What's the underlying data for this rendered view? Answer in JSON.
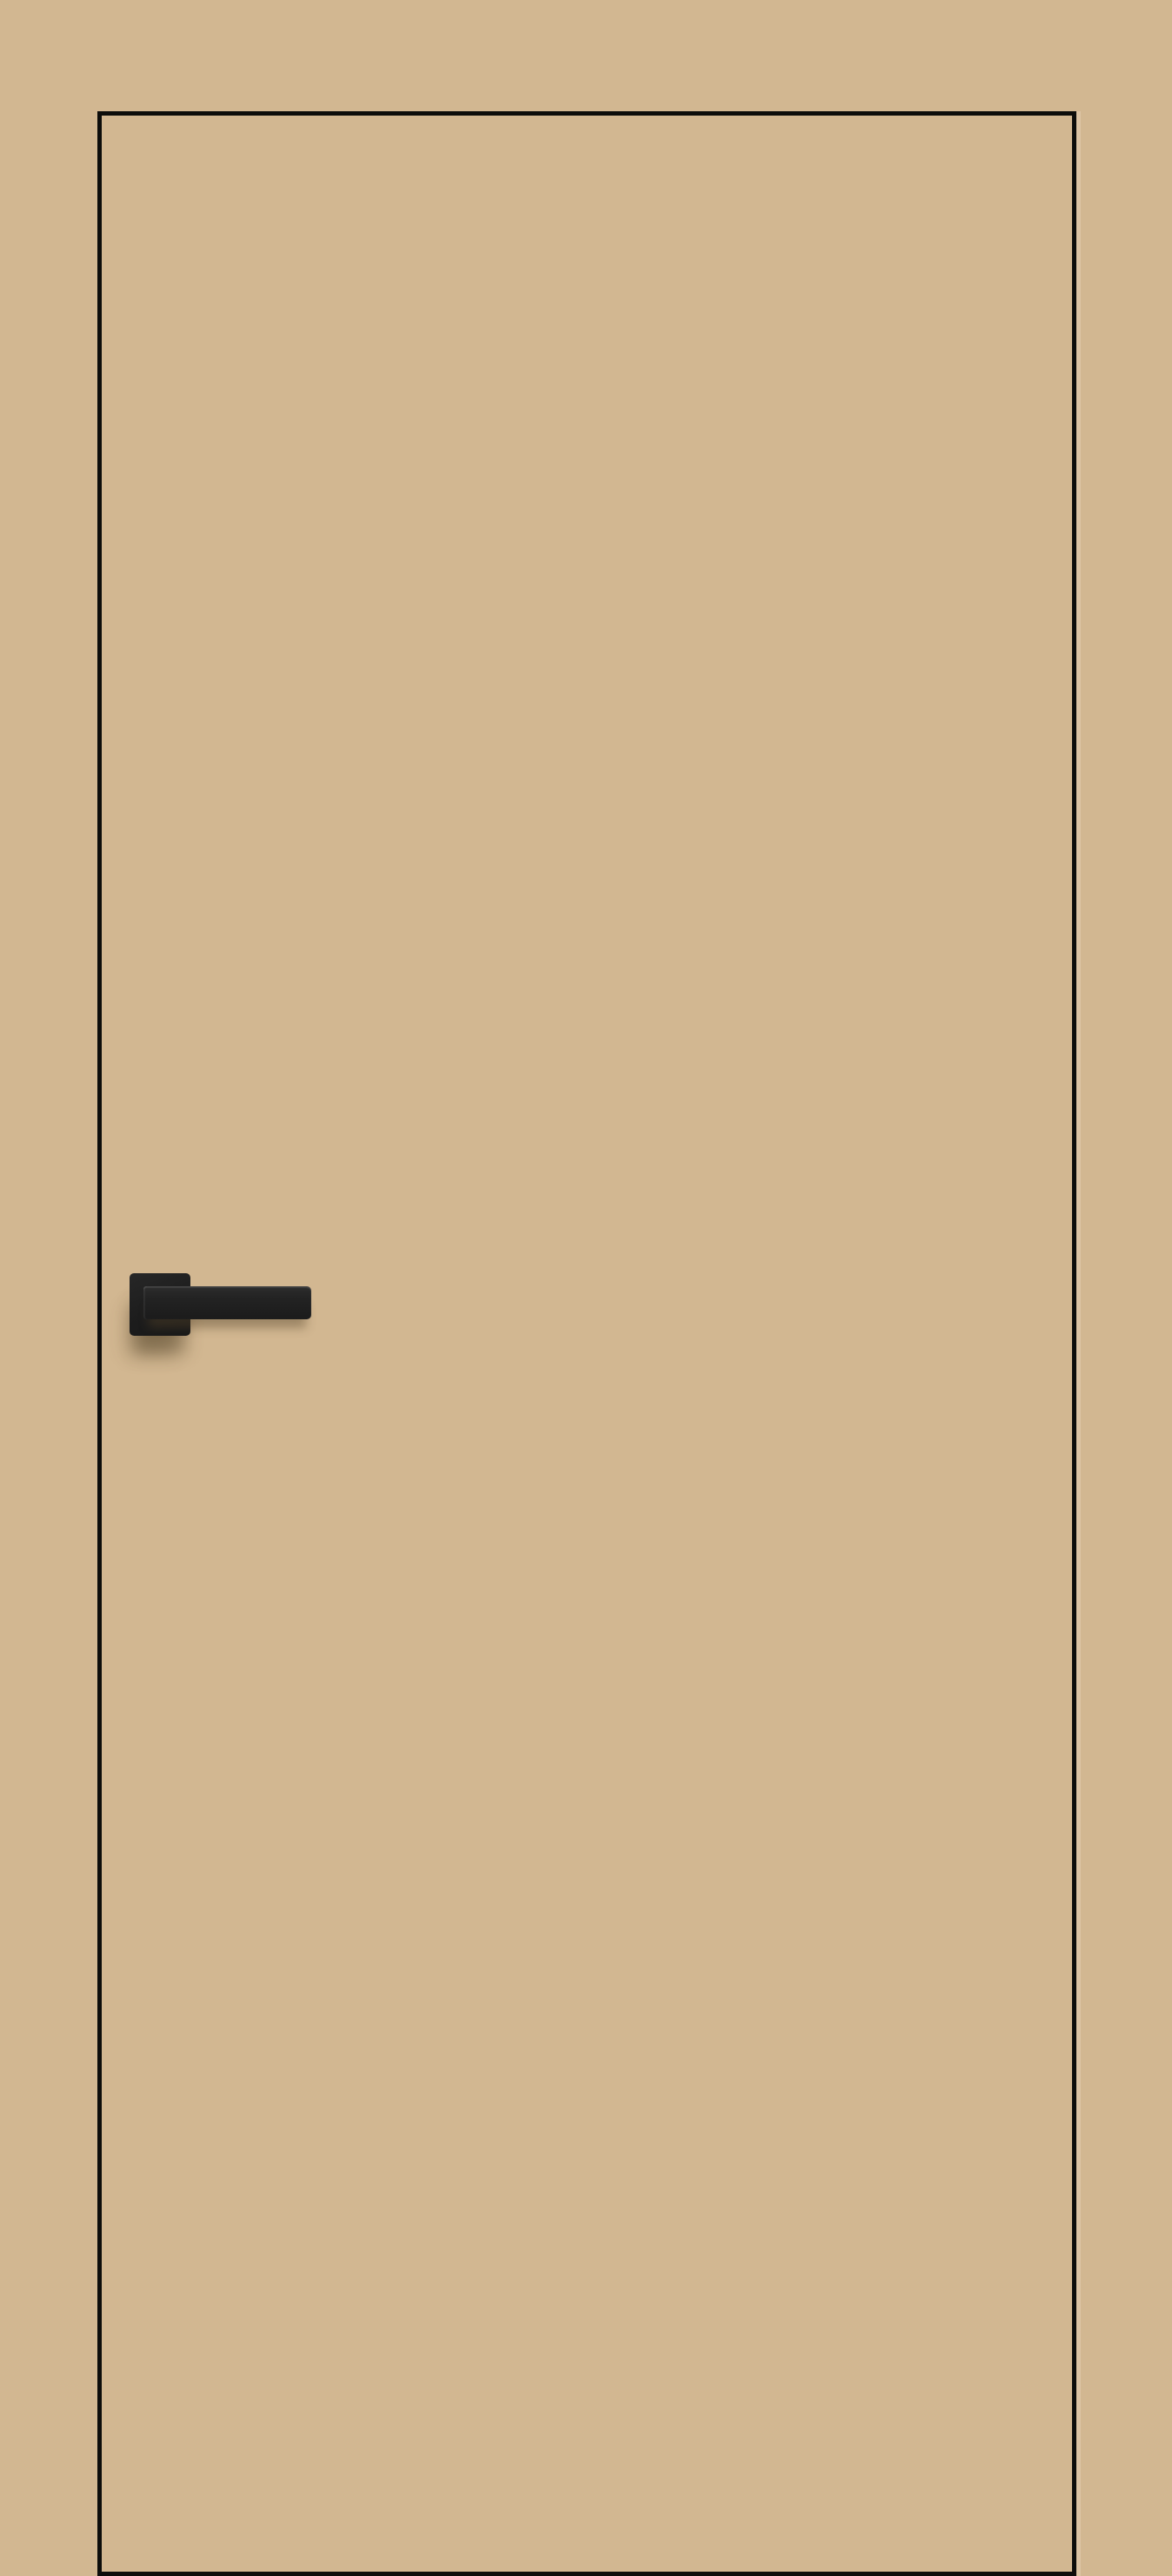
{
  "scene": {
    "subject": "Flush concealed interior door, tan finish identical to the surrounding wall, framed by a thin black edge trim, fitted with a matte black square-rosette lever handle on the left side",
    "objects": [
      {
        "name": "wall-background"
      },
      {
        "name": "door-leaf"
      },
      {
        "name": "door-edge-highlight"
      },
      {
        "name": "door-handle"
      },
      {
        "name": "handle-rosette"
      },
      {
        "name": "handle-lever"
      }
    ]
  },
  "palette": {
    "wall": "#d2b791",
    "door_face": "#d2b791",
    "edge_trim": "#0d0d0b",
    "rosette": "#1d1d1d",
    "rosette_light": "#272727",
    "lever_top": "#2d2d2d",
    "lever_bottom": "#1b1b1b",
    "shadow": "#534228"
  }
}
